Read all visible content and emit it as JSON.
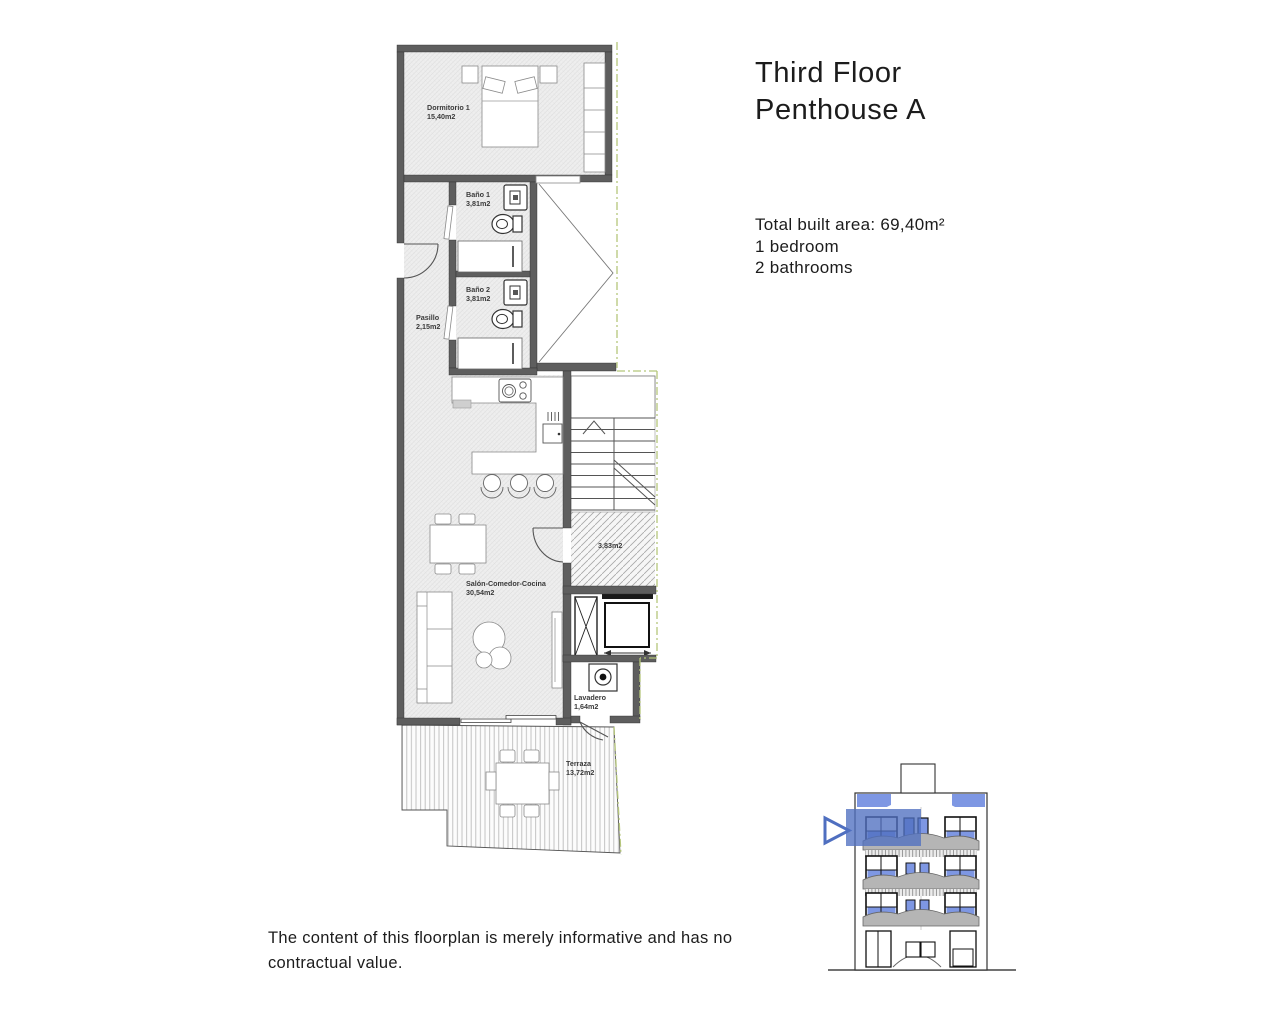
{
  "header": {
    "title_line1": "Third Floor",
    "title_line2": "Penthouse A"
  },
  "summary": {
    "built_area": "Total built area: 69,40m²",
    "bedrooms": "1 bedroom",
    "bathrooms": "2 bathrooms"
  },
  "disclaimer": "The content of this floorplan is merely informative and has no contractual value.",
  "floorplan": {
    "rooms": [
      {
        "name": "Dormitorio 1",
        "area": "15,40m2"
      },
      {
        "name": "Baño 1",
        "area": "3,81m2"
      },
      {
        "name": "Baño 2",
        "area": "3,81m2"
      },
      {
        "name": "Pasillo",
        "area": "2,15m2"
      },
      {
        "name": "Salón-Comedor-Cocina",
        "area": "30,54m2"
      },
      {
        "name": "",
        "area": "3,83m2"
      },
      {
        "name": "Lavadero",
        "area": "1,64m2"
      },
      {
        "name": "Terraza",
        "area": "13,72m2"
      }
    ],
    "colors": {
      "wall": "#5e5e5e",
      "boundary_green": "#b5c67b",
      "floor_hatch": "#eeeeee"
    }
  },
  "elevation": {
    "highlight_color": "#4f6fc0",
    "window_blue": "#7e97e3",
    "balcony_gray": "#b5b5b5",
    "floors": 4,
    "marked_floor": "third"
  }
}
